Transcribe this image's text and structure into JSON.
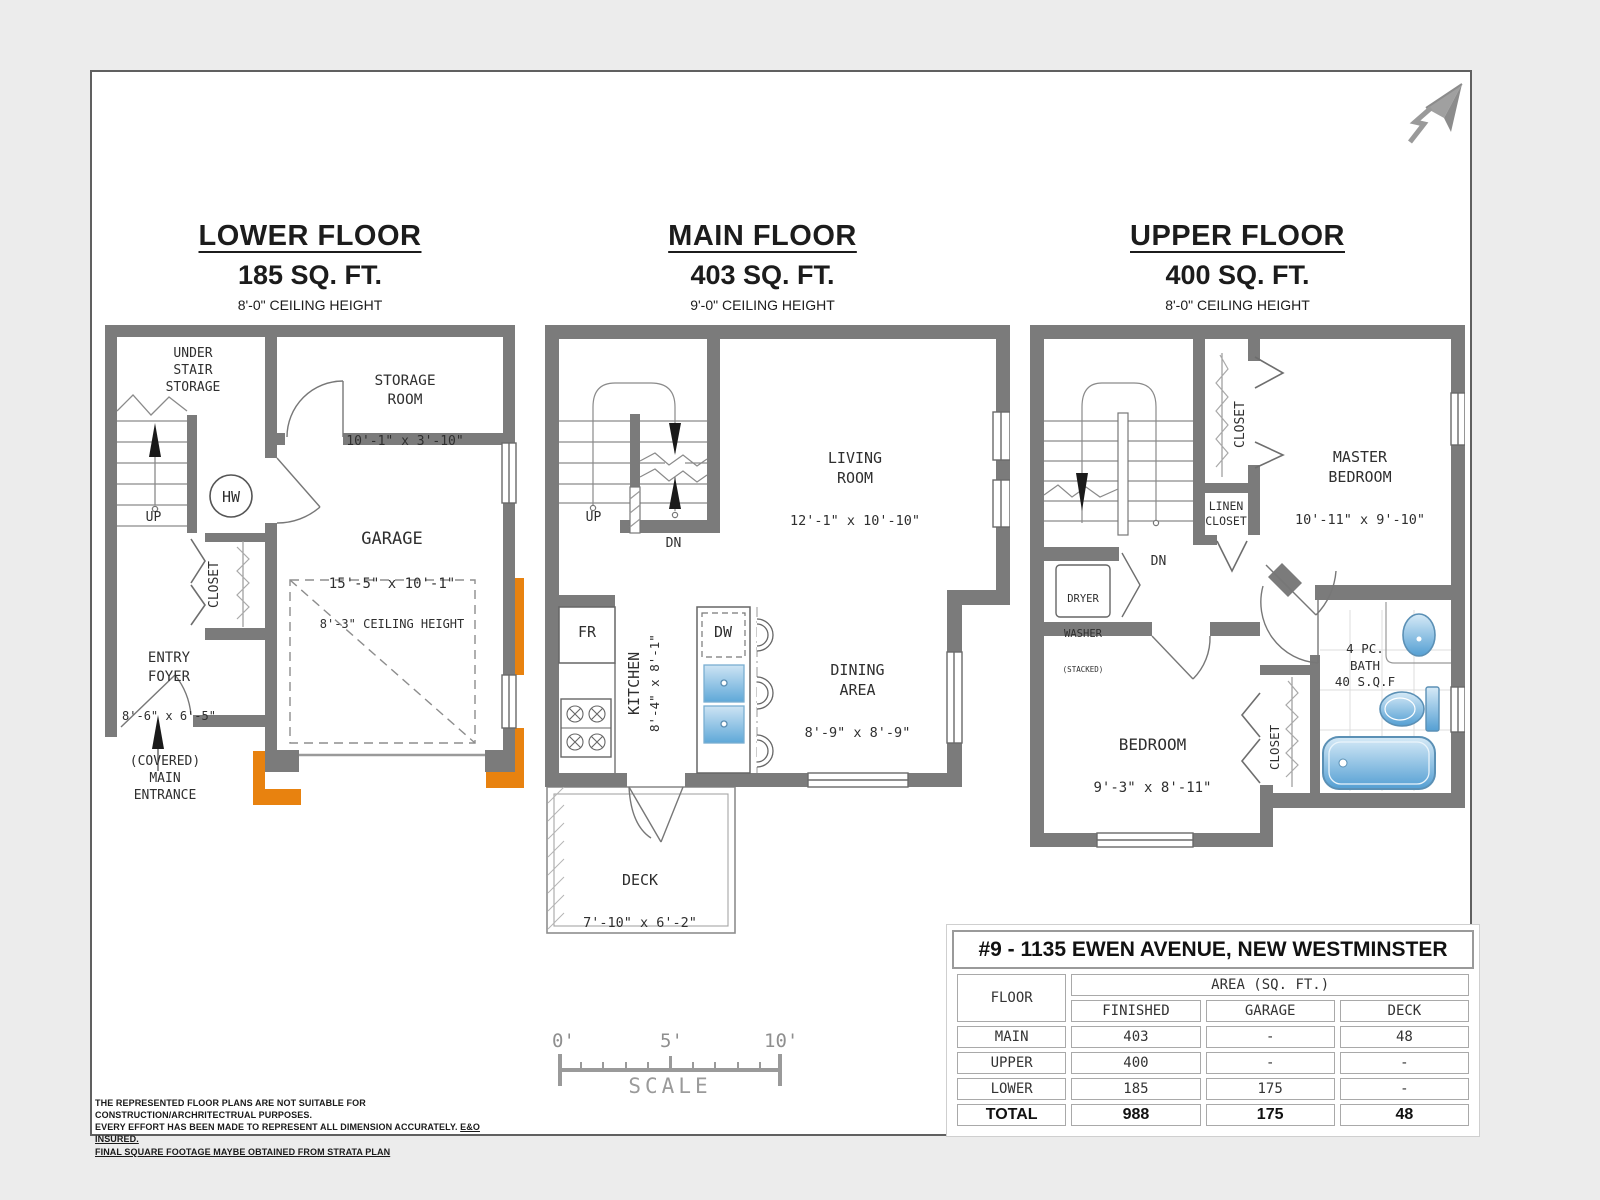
{
  "floors": {
    "lower": {
      "title": "LOWER FLOOR",
      "area": "185 SQ. FT.",
      "ceiling": "8'-0\" CEILING HEIGHT",
      "labels": {
        "under_stair_storage": "UNDER\nSTAIR\nSTORAGE",
        "up": "UP",
        "hw": "HW",
        "storage_room_name": "STORAGE\nROOM",
        "storage_room_dims": "10'-1\" x 3'-10\"",
        "garage_name": "GARAGE",
        "garage_dims": "15'-5\" x 10'-1\"",
        "garage_note": "8'-3\" CEILING HEIGHT",
        "closet": "CLOSET",
        "entry_foyer_name": "ENTRY\nFOYER",
        "entry_foyer_dims": "8'-6\" x 6'-5\"",
        "main_entrance": "(COVERED)\nMAIN\nENTRANCE"
      }
    },
    "main": {
      "title": "MAIN FLOOR",
      "area": "403 SQ. FT.",
      "ceiling": "9'-0\" CEILING HEIGHT",
      "labels": {
        "up": "UP",
        "dn": "DN",
        "living_name": "LIVING\nROOM",
        "living_dims": "12'-1\" x 10'-10\"",
        "kitchen_name": "KITCHEN",
        "kitchen_dims": "8'-4\" x 8'-1\"",
        "fr": "FR",
        "dw": "DW",
        "dining_name": "DINING\nAREA",
        "dining_dims": "8'-9\" x 8'-9\"",
        "deck_name": "DECK",
        "deck_dims": "7'-10\" x 6'-2\""
      }
    },
    "upper": {
      "title": "UPPER FLOOR",
      "area": "400 SQ. FT.",
      "ceiling": "8'-0\" CEILING HEIGHT",
      "labels": {
        "dn": "DN",
        "closet_top": "CLOSET",
        "master_name": "MASTER\nBEDROOM",
        "master_dims": "10'-11\" x 9'-10\"",
        "linen": "LINEN\nCLOSET",
        "laundry_line1": "DRYER",
        "laundry_line2": "WASHER",
        "laundry_line3": "(STACKED)",
        "bedroom_name": "BEDROOM",
        "bedroom_dims": "9'-3\" x 8'-11\"",
        "closet_bottom": "CLOSET",
        "bath": "4 PC.\nBATH\n40 S.Q.F"
      }
    }
  },
  "summary": {
    "address": "#9 - 1135 EWEN AVENUE, NEW WESTMINSTER",
    "floor_col": "FLOOR",
    "area_group": "AREA (SQ. FT.)",
    "columns": [
      "FINISHED",
      "GARAGE",
      "DECK"
    ],
    "rows": [
      {
        "floor": "MAIN",
        "finished": "403",
        "garage": "-",
        "deck": "48"
      },
      {
        "floor": "UPPER",
        "finished": "400",
        "garage": "-",
        "deck": "-"
      },
      {
        "floor": "LOWER",
        "finished": "185",
        "garage": "175",
        "deck": "-"
      }
    ],
    "total": {
      "floor": "TOTAL",
      "finished": "988",
      "garage": "175",
      "deck": "48"
    }
  },
  "scale": {
    "tick0": "0'",
    "tick5": "5'",
    "tick10": "10'",
    "caption": "SCALE"
  },
  "disclaimer": {
    "line1": "THE REPRESENTED FLOOR PLANS ARE NOT SUITABLE FOR CONSTRUCTION/ARCHRITECTRUAL PURPOSES.",
    "line2": "EVERY EFFORT HAS BEEN MADE TO REPRESENT ALL DIMENSION ACCURATELY.",
    "line2_underline": "E&O INSURED.",
    "line3": "FINAL SQUARE FOOTAGE MAYBE OBTAINED FROM STRATA PLAN"
  },
  "colors": {
    "wall": "#7b7b7b",
    "accent_orange": "#E8820F",
    "fixture_blue": "#5ea8d8"
  }
}
